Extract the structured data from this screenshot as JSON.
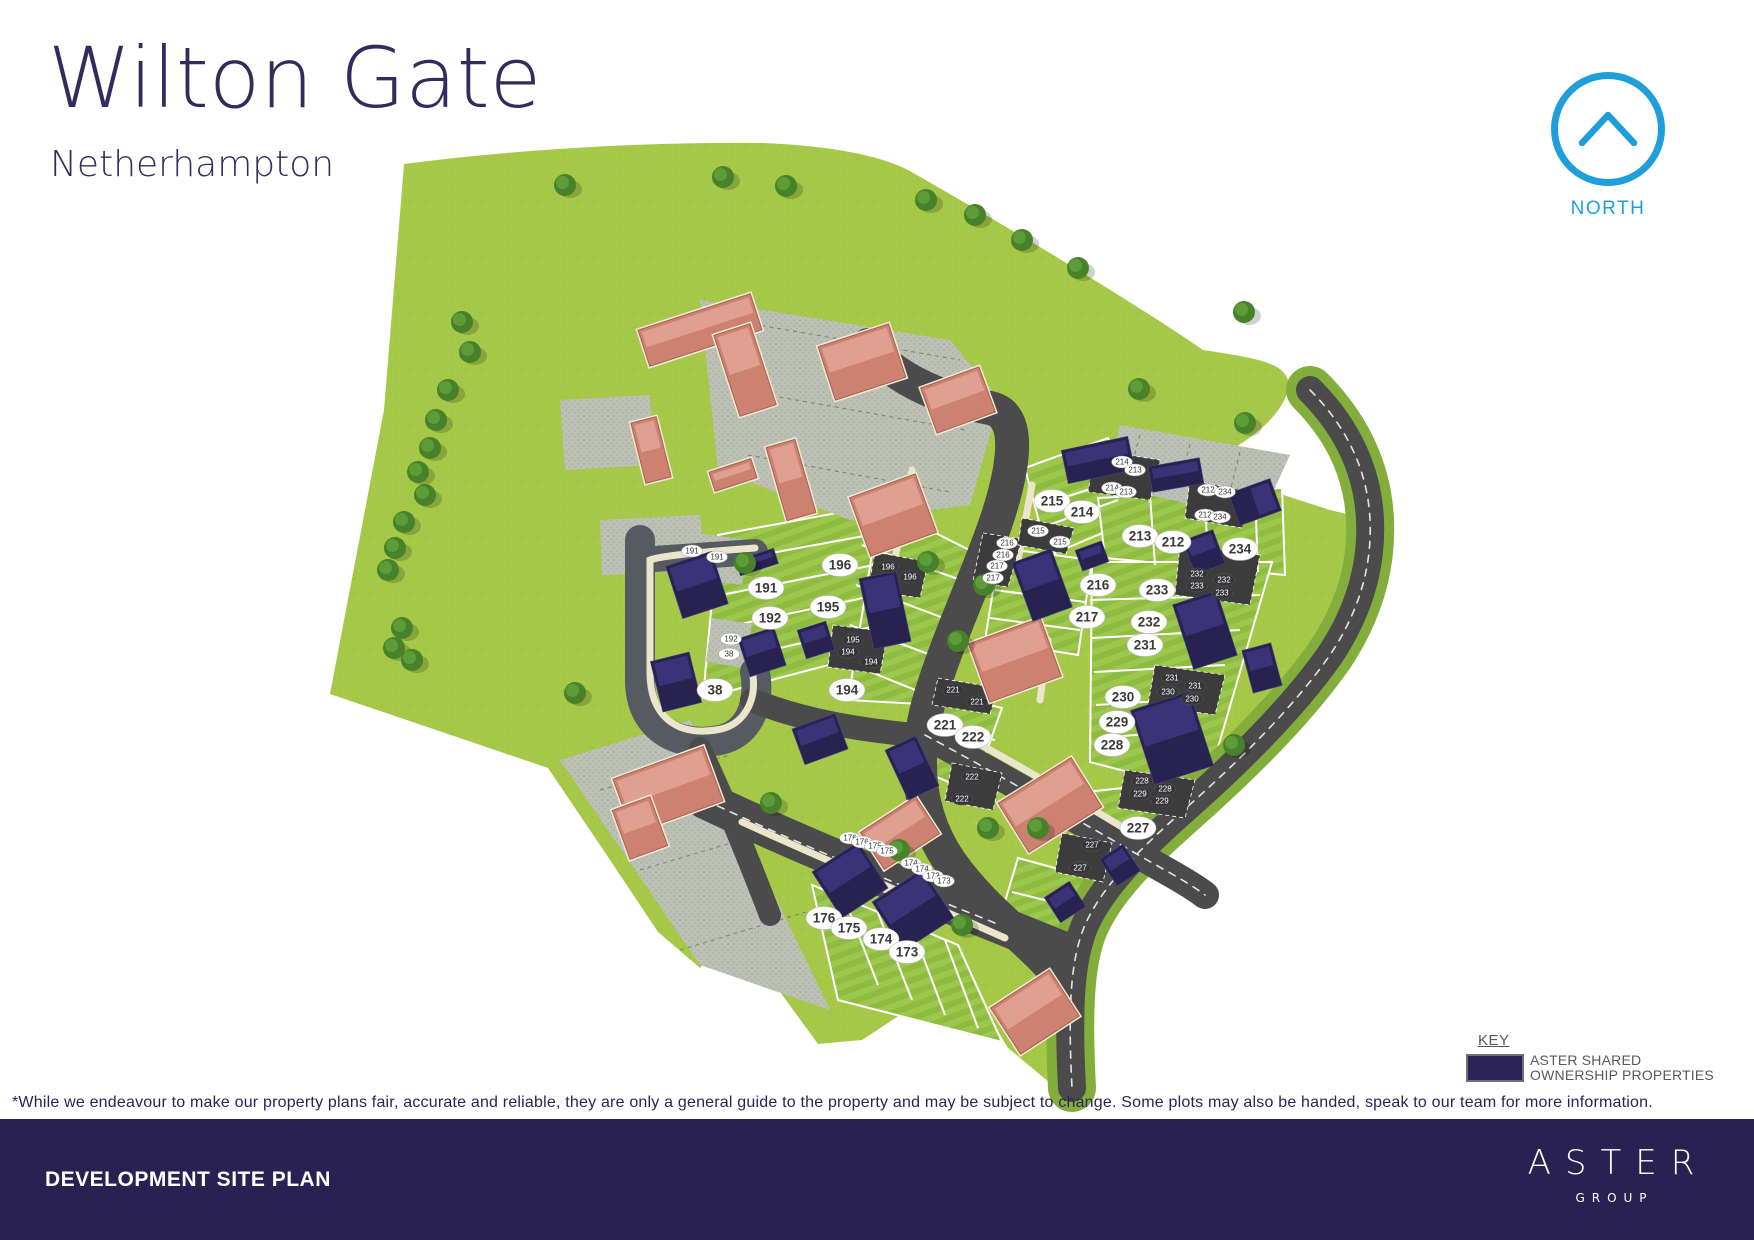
{
  "header": {
    "title": "Wilton Gate",
    "subtitle": "Netherhampton"
  },
  "north": {
    "label": "NORTH",
    "color": "#1e9fdc"
  },
  "key": {
    "heading": "KEY",
    "swatch_color": "#2b2358",
    "label_line1": "ASTER SHARED",
    "label_line2": "OWNERSHIP PROPERTIES"
  },
  "disclaimer": "*While we endeavour to make our property plans fair, accurate and reliable, they are only a general guide to the property and may be subject to change. Some plots may also be handed, speak to our team for more information.",
  "footer": {
    "left_title": "DEVELOPMENT SITE PLAN",
    "brand": "ASTER",
    "brand_sub": "GROUP",
    "bg": "#2a2153"
  },
  "colors": {
    "title": "#322b5e",
    "field_green": "#a6c848",
    "plot_green_a": "#8fbc40",
    "plot_green_b": "#9bc84d",
    "road": "#4b4b4b",
    "parking_light": "#bcc0b5",
    "parking_dark": "#3c3c3c",
    "path_cream": "#eae5cb",
    "house_salmon": "#cd8170",
    "house_navy": "#282251",
    "tree": "#47822b",
    "verge": "#84ae3c"
  },
  "site_plan": {
    "plots": [
      {
        "n": "191",
        "x": 766,
        "y": 588
      },
      {
        "n": "192",
        "x": 770,
        "y": 618
      },
      {
        "n": "38",
        "x": 715,
        "y": 690
      },
      {
        "n": "196",
        "x": 840,
        "y": 565
      },
      {
        "n": "195",
        "x": 828,
        "y": 607
      },
      {
        "n": "194",
        "x": 847,
        "y": 690
      },
      {
        "n": "215",
        "x": 1052,
        "y": 501
      },
      {
        "n": "214",
        "x": 1082,
        "y": 512
      },
      {
        "n": "213",
        "x": 1140,
        "y": 536
      },
      {
        "n": "212",
        "x": 1173,
        "y": 542
      },
      {
        "n": "234",
        "x": 1240,
        "y": 549
      },
      {
        "n": "216",
        "x": 1098,
        "y": 585
      },
      {
        "n": "233",
        "x": 1157,
        "y": 590
      },
      {
        "n": "217",
        "x": 1087,
        "y": 617
      },
      {
        "n": "232",
        "x": 1149,
        "y": 622
      },
      {
        "n": "231",
        "x": 1145,
        "y": 645
      },
      {
        "n": "230",
        "x": 1123,
        "y": 697
      },
      {
        "n": "229",
        "x": 1117,
        "y": 722
      },
      {
        "n": "228",
        "x": 1112,
        "y": 745
      },
      {
        "n": "221",
        "x": 945,
        "y": 725
      },
      {
        "n": "222",
        "x": 973,
        "y": 737
      },
      {
        "n": "227",
        "x": 1138,
        "y": 828
      },
      {
        "n": "176",
        "x": 824,
        "y": 918
      },
      {
        "n": "175",
        "x": 849,
        "y": 928
      },
      {
        "n": "174",
        "x": 881,
        "y": 939
      },
      {
        "n": "173",
        "x": 907,
        "y": 952
      }
    ],
    "parking_labels_light": [
      {
        "n": "191",
        "x": 692,
        "y": 551
      },
      {
        "n": "191",
        "x": 717,
        "y": 557
      },
      {
        "n": "192",
        "x": 731,
        "y": 639
      },
      {
        "n": "38",
        "x": 729,
        "y": 654
      },
      {
        "n": "176",
        "x": 850,
        "y": 838
      },
      {
        "n": "176",
        "x": 862,
        "y": 842
      },
      {
        "n": "175",
        "x": 875,
        "y": 846
      },
      {
        "n": "175",
        "x": 887,
        "y": 851
      },
      {
        "n": "174",
        "x": 911,
        "y": 863
      },
      {
        "n": "174",
        "x": 922,
        "y": 869
      },
      {
        "n": "173",
        "x": 933,
        "y": 876
      },
      {
        "n": "173",
        "x": 944,
        "y": 881
      },
      {
        "n": "214",
        "x": 1122,
        "y": 462
      },
      {
        "n": "213",
        "x": 1135,
        "y": 470
      },
      {
        "n": "214",
        "x": 1112,
        "y": 488
      },
      {
        "n": "213",
        "x": 1126,
        "y": 492
      },
      {
        "n": "212",
        "x": 1208,
        "y": 490
      },
      {
        "n": "234",
        "x": 1225,
        "y": 492
      },
      {
        "n": "212",
        "x": 1205,
        "y": 515
      },
      {
        "n": "234",
        "x": 1220,
        "y": 517
      },
      {
        "n": "215",
        "x": 1038,
        "y": 531
      },
      {
        "n": "215",
        "x": 1060,
        "y": 542
      },
      {
        "n": "216",
        "x": 1007,
        "y": 543
      },
      {
        "n": "216",
        "x": 1003,
        "y": 555
      },
      {
        "n": "217",
        "x": 997,
        "y": 566
      },
      {
        "n": "217",
        "x": 993,
        "y": 578
      }
    ],
    "parking_labels_dark": [
      {
        "n": "196",
        "x": 888,
        "y": 567
      },
      {
        "n": "196",
        "x": 910,
        "y": 577
      },
      {
        "n": "195",
        "x": 853,
        "y": 640
      },
      {
        "n": "194",
        "x": 848,
        "y": 652
      },
      {
        "n": "194",
        "x": 871,
        "y": 662
      },
      {
        "n": "232",
        "x": 1197,
        "y": 574
      },
      {
        "n": "232",
        "x": 1224,
        "y": 580
      },
      {
        "n": "233",
        "x": 1197,
        "y": 586
      },
      {
        "n": "233",
        "x": 1222,
        "y": 593
      },
      {
        "n": "231",
        "x": 1172,
        "y": 678
      },
      {
        "n": "231",
        "x": 1195,
        "y": 686
      },
      {
        "n": "230",
        "x": 1168,
        "y": 692
      },
      {
        "n": "230",
        "x": 1192,
        "y": 699
      },
      {
        "n": "228",
        "x": 1142,
        "y": 781
      },
      {
        "n": "228",
        "x": 1165,
        "y": 789
      },
      {
        "n": "229",
        "x": 1140,
        "y": 794
      },
      {
        "n": "229",
        "x": 1162,
        "y": 801
      },
      {
        "n": "221",
        "x": 953,
        "y": 690
      },
      {
        "n": "221",
        "x": 977,
        "y": 702
      },
      {
        "n": "222",
        "x": 972,
        "y": 777
      },
      {
        "n": "222",
        "x": 962,
        "y": 799
      },
      {
        "n": "227",
        "x": 1092,
        "y": 845
      },
      {
        "n": "227",
        "x": 1080,
        "y": 868
      }
    ],
    "houses": [
      {
        "t": "salmon",
        "x": 700,
        "y": 330,
        "w": 118,
        "h": 38,
        "r": -18
      },
      {
        "t": "salmon",
        "x": 745,
        "y": 370,
        "w": 38,
        "h": 85,
        "r": -18
      },
      {
        "t": "salmon",
        "x": 862,
        "y": 362,
        "w": 74,
        "h": 56,
        "r": -18
      },
      {
        "t": "salmon",
        "x": 958,
        "y": 400,
        "w": 62,
        "h": 48,
        "r": -20
      },
      {
        "t": "salmon",
        "x": 733,
        "y": 475,
        "w": 44,
        "h": 20,
        "r": -18
      },
      {
        "t": "salmon",
        "x": 651,
        "y": 450,
        "w": 26,
        "h": 62,
        "r": -14
      },
      {
        "t": "salmon",
        "x": 791,
        "y": 480,
        "w": 30,
        "h": 76,
        "r": -16
      },
      {
        "t": "salmon",
        "x": 893,
        "y": 515,
        "w": 70,
        "h": 62,
        "r": -20
      },
      {
        "t": "salmon",
        "x": 1015,
        "y": 660,
        "w": 76,
        "h": 62,
        "r": -20
      },
      {
        "t": "salmon",
        "x": 1050,
        "y": 805,
        "w": 86,
        "h": 58,
        "r": -32
      },
      {
        "t": "salmon",
        "x": 668,
        "y": 790,
        "w": 96,
        "h": 58,
        "r": -20
      },
      {
        "t": "salmon",
        "x": 640,
        "y": 828,
        "w": 40,
        "h": 52,
        "r": -20
      },
      {
        "t": "salmon",
        "x": 900,
        "y": 833,
        "w": 66,
        "h": 44,
        "r": -33
      },
      {
        "t": "salmon",
        "x": 1035,
        "y": 1012,
        "w": 70,
        "h": 55,
        "r": -33
      },
      {
        "t": "navy",
        "x": 697,
        "y": 585,
        "w": 48,
        "h": 55,
        "r": -18
      },
      {
        "t": "navy",
        "x": 757,
        "y": 562,
        "w": 40,
        "h": 16,
        "r": -18
      },
      {
        "t": "navy",
        "x": 676,
        "y": 682,
        "w": 40,
        "h": 52,
        "r": -14
      },
      {
        "t": "navy",
        "x": 762,
        "y": 652,
        "w": 38,
        "h": 40,
        "r": -18
      },
      {
        "t": "navy",
        "x": 816,
        "y": 640,
        "w": 30,
        "h": 30,
        "r": -18
      },
      {
        "t": "navy",
        "x": 885,
        "y": 610,
        "w": 38,
        "h": 72,
        "r": -12
      },
      {
        "t": "navy",
        "x": 820,
        "y": 739,
        "w": 46,
        "h": 38,
        "r": -20
      },
      {
        "t": "navy",
        "x": 912,
        "y": 768,
        "w": 34,
        "h": 55,
        "r": -25
      },
      {
        "t": "navy",
        "x": 850,
        "y": 880,
        "w": 55,
        "h": 55,
        "r": -33
      },
      {
        "t": "navy",
        "x": 913,
        "y": 910,
        "w": 60,
        "h": 58,
        "r": -33
      },
      {
        "t": "navy",
        "x": 1098,
        "y": 460,
        "w": 68,
        "h": 34,
        "r": -12
      },
      {
        "t": "navy",
        "x": 1176,
        "y": 475,
        "w": 52,
        "h": 26,
        "r": -10
      },
      {
        "t": "navy",
        "x": 1255,
        "y": 502,
        "w": 34,
        "h": 44,
        "r": 70
      },
      {
        "t": "navy",
        "x": 1092,
        "y": 556,
        "w": 28,
        "h": 22,
        "r": -20
      },
      {
        "t": "navy",
        "x": 1204,
        "y": 552,
        "w": 32,
        "h": 36,
        "r": -20
      },
      {
        "t": "navy",
        "x": 1042,
        "y": 585,
        "w": 42,
        "h": 62,
        "r": -20
      },
      {
        "t": "navy",
        "x": 1205,
        "y": 630,
        "w": 46,
        "h": 68,
        "r": -18
      },
      {
        "t": "navy",
        "x": 1172,
        "y": 738,
        "w": 62,
        "h": 78,
        "r": -18
      },
      {
        "t": "navy",
        "x": 1262,
        "y": 668,
        "w": 30,
        "h": 44,
        "r": -15
      },
      {
        "t": "navy",
        "x": 1120,
        "y": 865,
        "w": 28,
        "h": 32,
        "r": -33
      },
      {
        "t": "navy",
        "x": 1065,
        "y": 902,
        "w": 30,
        "h": 30,
        "r": -33
      }
    ],
    "trees": [
      [
        565,
        185
      ],
      [
        723,
        177
      ],
      [
        786,
        186
      ],
      [
        926,
        200
      ],
      [
        975,
        215
      ],
      [
        1022,
        240
      ],
      [
        1078,
        268
      ],
      [
        1244,
        312
      ],
      [
        1139,
        389
      ],
      [
        1245,
        423
      ],
      [
        462,
        322
      ],
      [
        470,
        352
      ],
      [
        448,
        390
      ],
      [
        436,
        420
      ],
      [
        430,
        448
      ],
      [
        418,
        472
      ],
      [
        425,
        495
      ],
      [
        404,
        522
      ],
      [
        395,
        548
      ],
      [
        388,
        570
      ],
      [
        402,
        628
      ],
      [
        394,
        648
      ],
      [
        412,
        660
      ],
      [
        575,
        693
      ],
      [
        745,
        563
      ],
      [
        928,
        562
      ],
      [
        984,
        585
      ],
      [
        1234,
        745
      ],
      [
        958,
        641
      ],
      [
        988,
        828
      ],
      [
        899,
        850
      ],
      [
        1038,
        828
      ],
      [
        771,
        803
      ],
      [
        962,
        925
      ]
    ],
    "plot_lines": [
      [
        722,
        562,
        886,
        532
      ],
      [
        726,
        594,
        889,
        562
      ],
      [
        731,
        626,
        891,
        592
      ],
      [
        736,
        658,
        893,
        622
      ],
      [
        862,
        545,
        975,
        585
      ],
      [
        856,
        585,
        962,
        625
      ],
      [
        850,
        625,
        950,
        662
      ],
      [
        846,
        662,
        940,
        700
      ],
      [
        1040,
        505,
        1125,
        478
      ],
      [
        1035,
        530,
        1118,
        500
      ],
      [
        1150,
        495,
        1155,
        565
      ],
      [
        1205,
        492,
        1208,
        570
      ],
      [
        1255,
        490,
        1258,
        572
      ],
      [
        995,
        590,
        1085,
        602
      ],
      [
        990,
        618,
        1080,
        630
      ],
      [
        1090,
        600,
        1260,
        595
      ],
      [
        1092,
        638,
        1240,
        630
      ],
      [
        1094,
        672,
        1225,
        665
      ],
      [
        1096,
        705,
        1210,
        698
      ],
      [
        1098,
        738,
        1200,
        730
      ],
      [
        912,
        722,
        995,
        740
      ],
      [
        908,
        750,
        985,
        768
      ],
      [
        1082,
        828,
        1172,
        820
      ],
      [
        845,
        900,
        878,
        985
      ],
      [
        878,
        913,
        912,
        1000
      ],
      [
        912,
        927,
        945,
        1015
      ],
      [
        945,
        940,
        978,
        1028
      ],
      [
        1012,
        892,
        1085,
        910
      ]
    ]
  }
}
